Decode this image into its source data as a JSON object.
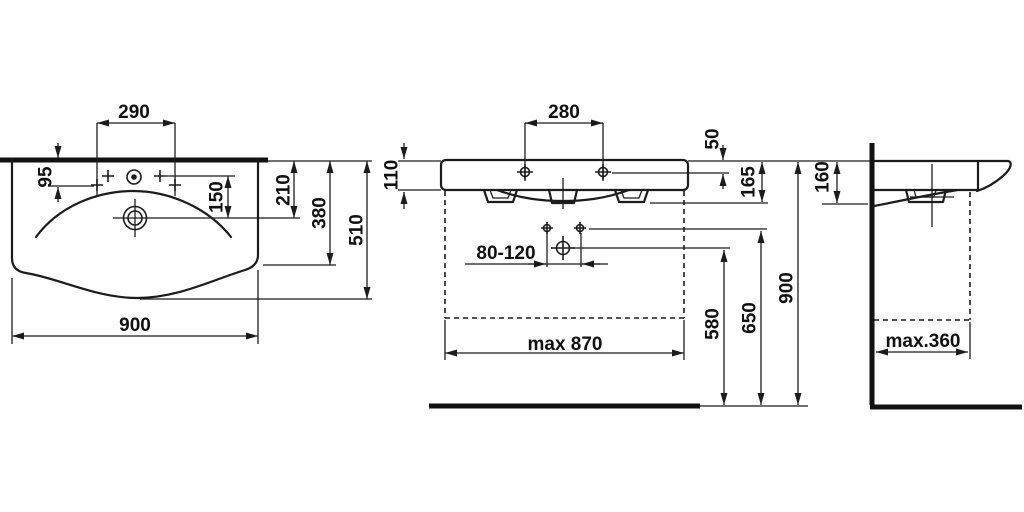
{
  "colors": {
    "line": "#1c1c1c",
    "background": "#ffffff"
  },
  "labels": {
    "plan": {
      "hole_spacing": "290",
      "hole_offset": "95",
      "drain_offset": "150",
      "depth_210": "210",
      "depth_380": "380",
      "depth_510": "510",
      "width": "900"
    },
    "front": {
      "hole_spacing": "280",
      "hole_drop": "50",
      "apron_height": "110",
      "body_height": "165",
      "trap_range": "80-120",
      "drain_height": "580",
      "fixing_height": "650",
      "rim_height": "900",
      "max_clearance_width": "max 870"
    },
    "side": {
      "body_height": "160",
      "max_depth": "max.360"
    }
  }
}
